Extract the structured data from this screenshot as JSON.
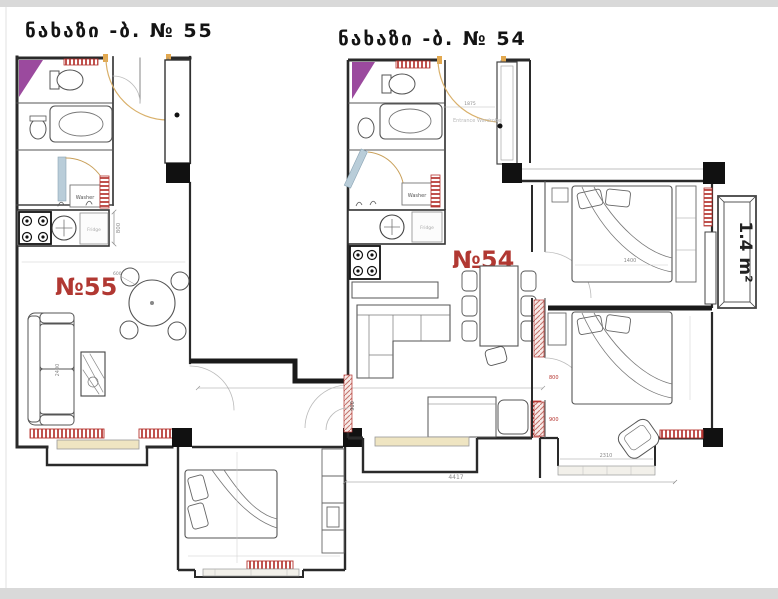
{
  "colors": {
    "accent_red": "#b13832",
    "radiator_red": "#b5342f",
    "purple": "#9b4a9e",
    "door_tan": "#d9b06a",
    "window_cream": "#efe5c2",
    "column_black": "#111111",
    "wall": "#2a2a2a",
    "frame_gray": "#d9d9d9"
  },
  "titles": {
    "apt55": "ნახაზი -ბ. № 55",
    "apt54": "ნახაზი -ბ. № 54"
  },
  "apt55": {
    "label": "№55",
    "washer": "Washer",
    "fridge": "Fridge",
    "dims": {
      "fridge_depth": "800",
      "sofa_length": "2400",
      "table": "600"
    }
  },
  "apt54": {
    "label": "№54",
    "washer": "Washer",
    "fridge": "Fridge",
    "hall_label": "Entrance Wardrobe",
    "dims": {
      "hall_width": "1875",
      "door": "900",
      "total_width": "4417"
    }
  },
  "bedrooms": {
    "top": {
      "dims": {
        "bed_width": "1400"
      }
    },
    "bottom": {
      "wardrobe": "wardrobe",
      "dims": {
        "seg1": "1100",
        "seg2": "800",
        "seg3": "900",
        "window": "2310"
      }
    },
    "balcony": {
      "area": "1.4 m²"
    }
  }
}
